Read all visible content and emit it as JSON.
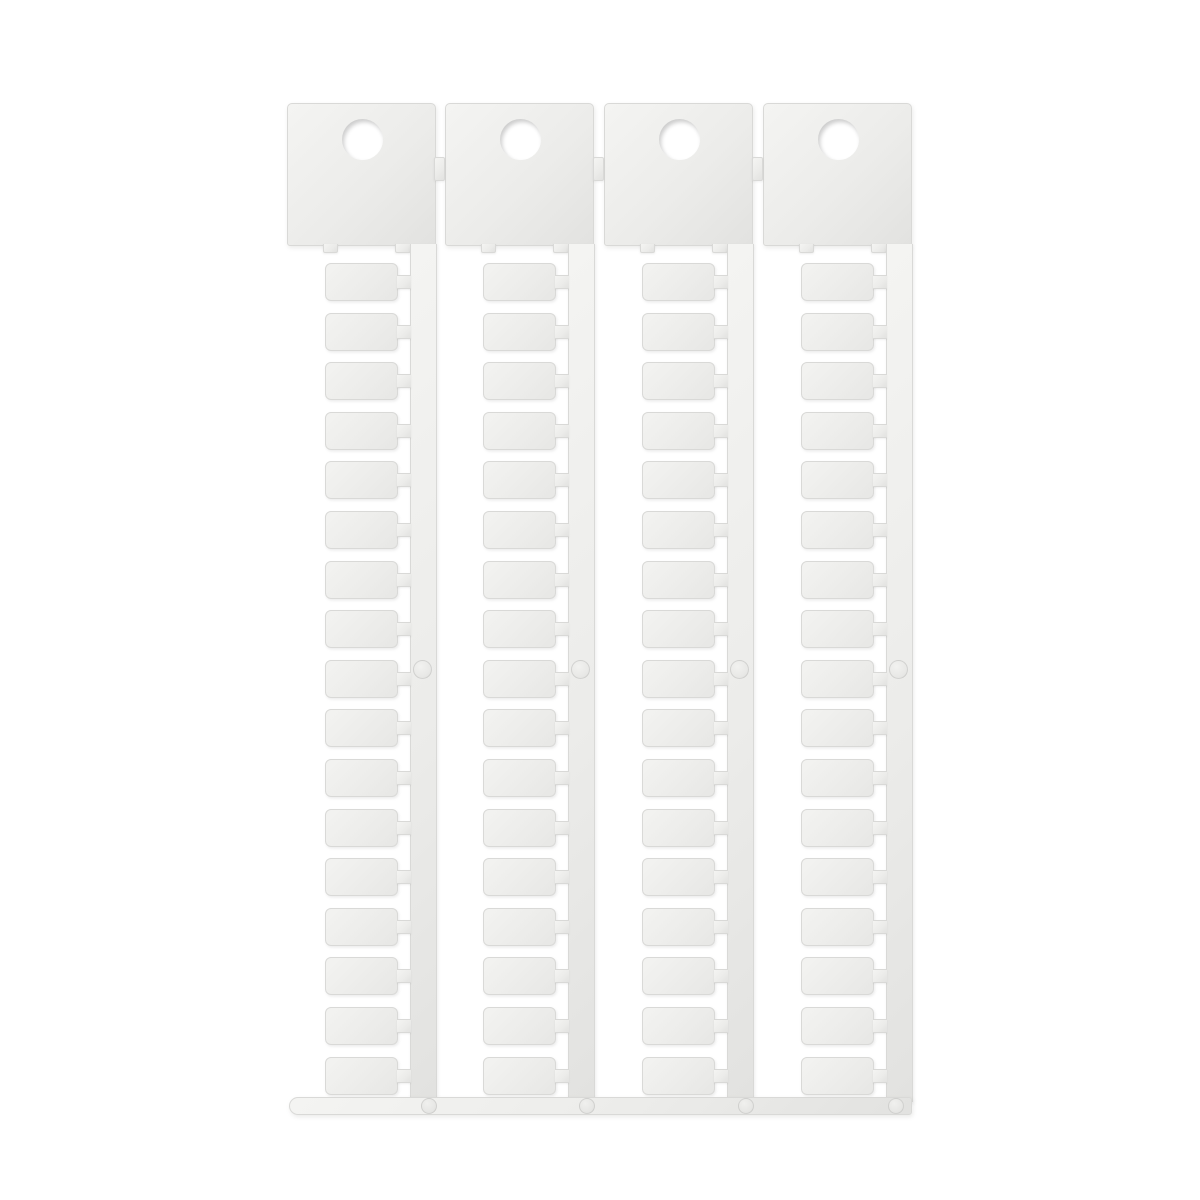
{
  "photo": {
    "subject": "blank white plastic terminal-marker tag card (sprue) with hanging tabs",
    "sprue": {
      "strip_count": 4,
      "tags_per_strip": 17,
      "holes_per_strip": 1,
      "header_connector_count": 3,
      "has_bottom_runner_bar": true,
      "tags_blank": true
    }
  },
  "colors": {
    "background": "#ffffff",
    "plastic_highlight": "#f4f4f2",
    "plastic": "#ececea",
    "plastic_shadow": "#e2e2e0",
    "plastic_edge": "#d9d9d7"
  },
  "geometry_hints": {
    "strip_left_px": [
      287,
      445,
      604,
      763
    ],
    "header_connector_left_px": [
      434,
      593,
      752
    ],
    "runner_mark_left_px": [
      421,
      579,
      738,
      888
    ]
  }
}
